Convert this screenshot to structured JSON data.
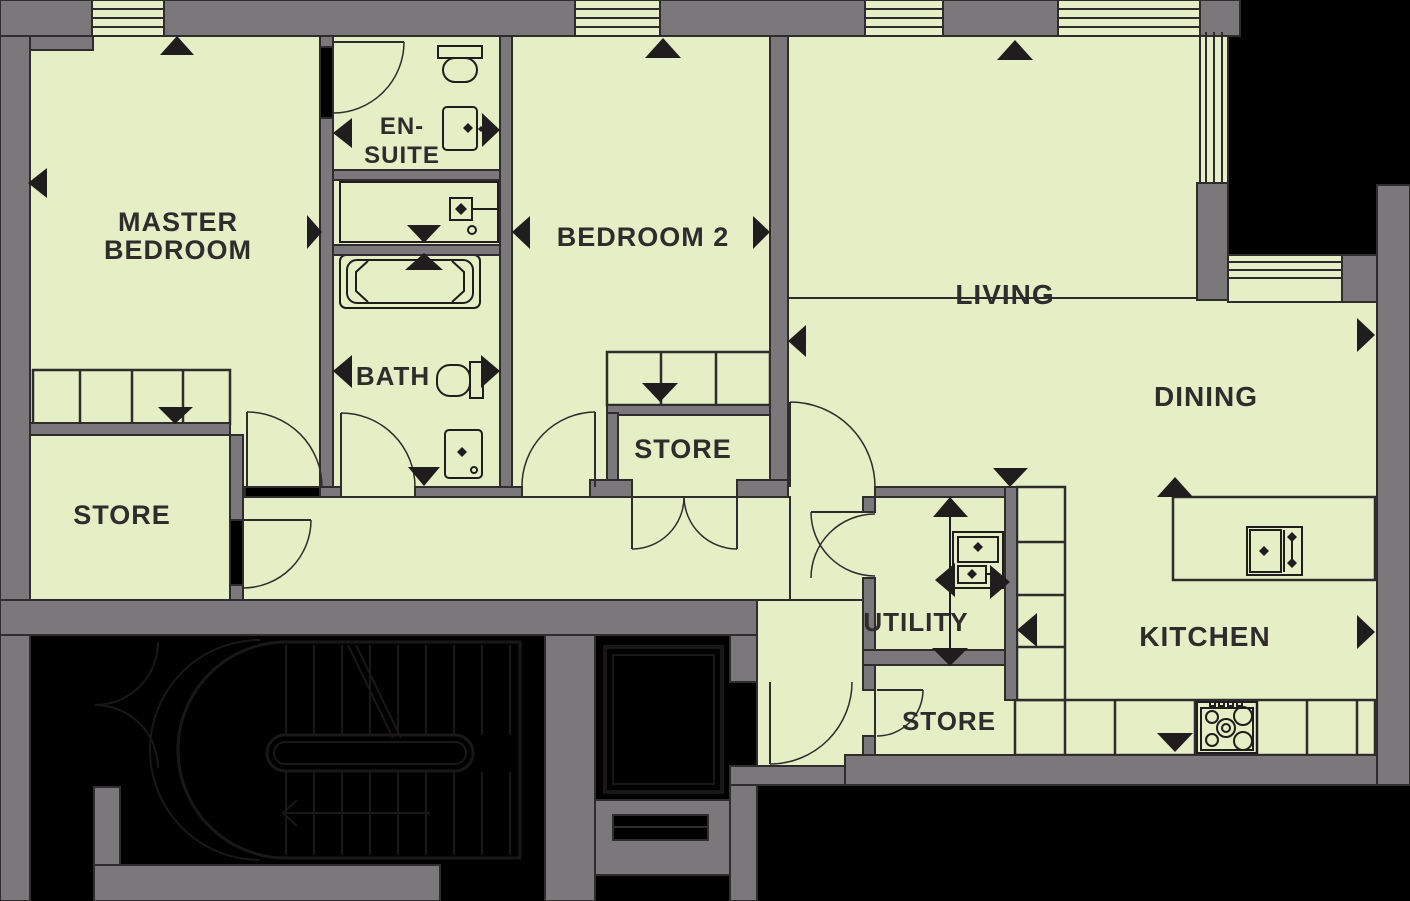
{
  "floorplan": {
    "title": "Apartment floor plan",
    "colors": {
      "floor": "#e5eec5",
      "wall": "#7a787a",
      "outline": "#2e2c2d",
      "arrow": "#1f1d1e",
      "outside": "#000000",
      "text": "#2e2c2d"
    },
    "rooms": {
      "master": {
        "line1": "MASTER",
        "line2": "BEDROOM"
      },
      "ensuite": {
        "line1": "EN-",
        "line2": "SUITE"
      },
      "bath": {
        "label": "BATH"
      },
      "bedroom2": {
        "label": "BEDROOM 2"
      },
      "living": {
        "label": "LIVING"
      },
      "dining": {
        "label": "DINING"
      },
      "kitchen": {
        "label": "KITCHEN"
      },
      "utility": {
        "label": "UTILITY"
      },
      "store_left": {
        "label": "STORE"
      },
      "store_center": {
        "label": "STORE"
      },
      "store_utility": {
        "label": "STORE"
      }
    },
    "fixtures": [
      "toilet-icon",
      "basin-icon",
      "bathtub-icon",
      "shower-icon",
      "washing-machine-icon",
      "sink-icon",
      "hob-icon",
      "wardrobe",
      "kitchen-counter",
      "kitchen-island",
      "staircase",
      "elevator"
    ]
  }
}
